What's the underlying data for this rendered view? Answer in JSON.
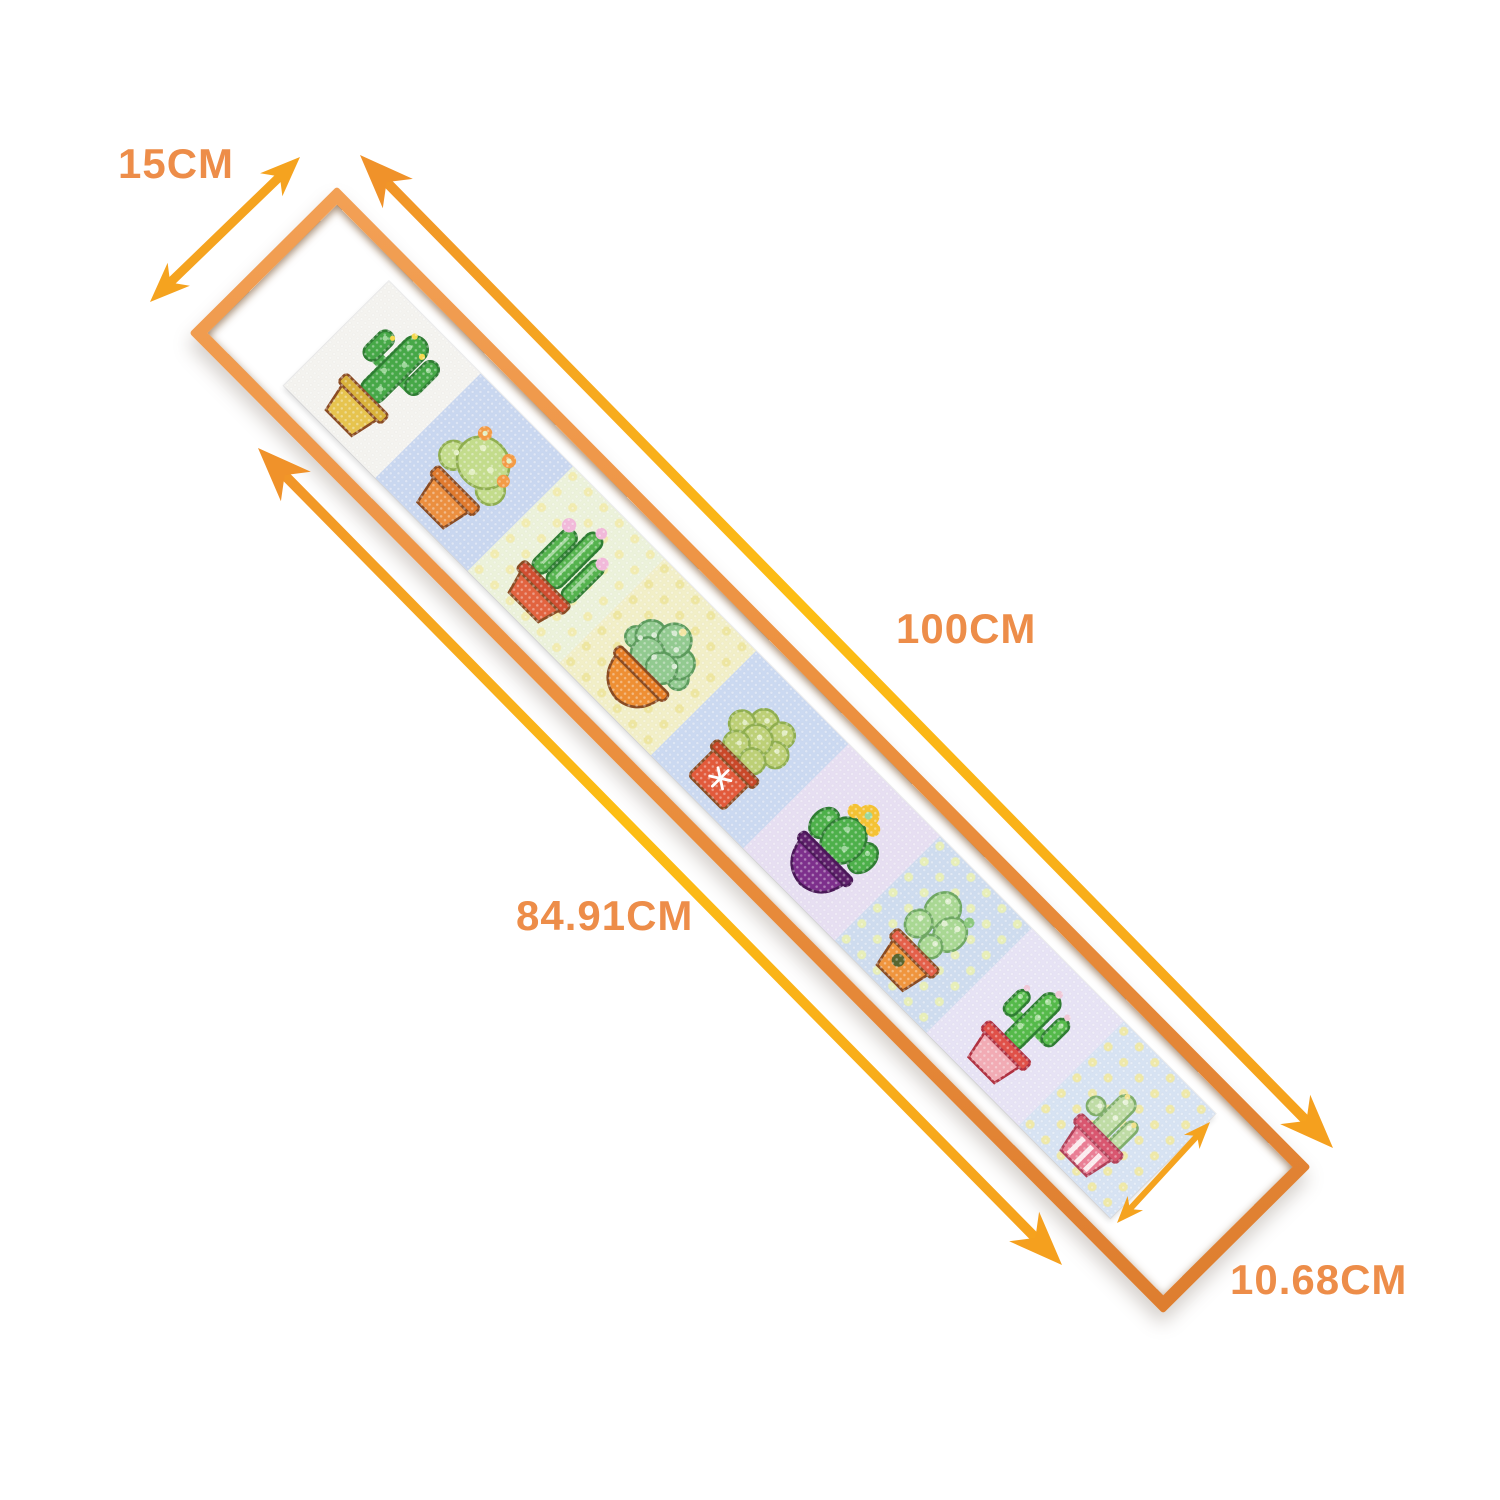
{
  "dimensions": {
    "frame_width": {
      "label": "15CM"
    },
    "frame_length": {
      "label": "100CM"
    },
    "art_length": {
      "label": "84.91CM"
    },
    "art_width": {
      "label": "10.68CM"
    }
  },
  "colors": {
    "label_text": "#ED8D49",
    "arrow": "#F5A31F",
    "arrow_gradient_start": "#F0922A",
    "arrow_gradient_mid": "#FDBE13",
    "arrow_gradient_end": "#F5A01E",
    "frame_wood": "#EC9140",
    "mat": "#FFFFFF"
  },
  "artwork": {
    "panels": [
      {
        "name": "saguaro-cactus-yellow-pot",
        "plant": "saguaro",
        "pot_shape": "flower",
        "bg": "#F4F3EF",
        "polka": "",
        "stripes": false,
        "body": "#46A847",
        "light": "#9ED89B",
        "accent": "#F6D94E",
        "outline": "#2E7D32",
        "pot": "#E7C44E",
        "pot_rim": "#D9B23B",
        "pot_outline": "#8A4B22",
        "pot_decor": ""
      },
      {
        "name": "round-cactus-orange-flowers",
        "plant": "roundpad",
        "pot_shape": "flower",
        "bg": "#C9D7F0",
        "polka": "",
        "stripes": false,
        "body": "#C3DC8B",
        "light": "#E4F0C4",
        "accent": "#F49B45",
        "outline": "#8FAE4F",
        "pot": "#EC8F3F",
        "pot_rim": "#E07A2E",
        "pot_outline": "#8A4B22",
        "pot_decor": ""
      },
      {
        "name": "column-cacti-pink-flowers",
        "plant": "columns",
        "pot_shape": "lowpot",
        "bg": "#ECF2DA",
        "polka": "#F2ECB0",
        "stripes": false,
        "body": "#55B34E",
        "light": "#A6D8A1",
        "accent": "#F2B9DA",
        "outline": "#2E7D32",
        "pot": "#E2633F",
        "pot_rim": "#D14E31",
        "pot_outline": "#8A4B22",
        "pot_decor": ""
      },
      {
        "name": "bushy-cactus-orange-bowl",
        "plant": "bush",
        "pot_shape": "bowl",
        "bg": "#F2EFC7",
        "polka": "#EEE6A0",
        "stripes": false,
        "body": "#92CA90",
        "light": "#D8EBD4",
        "accent": "#F4E6A3",
        "outline": "#5C9B5C",
        "pot": "#EF8F33",
        "pot_rim": "#E67C24",
        "pot_outline": "#8A4B22",
        "pot_decor": ""
      },
      {
        "name": "pad-cluster-red-box-pot",
        "plant": "pads",
        "pot_shape": "box",
        "bg": "#CBD9F1",
        "polka": "",
        "stripes": false,
        "body": "#BDD076",
        "light": "#E4EEC5",
        "accent": "#FFFFFF",
        "outline": "#8FAE4F",
        "pot": "#E25A3B",
        "pot_rim": "#C94829",
        "pot_outline": "#8A4B22",
        "pot_decor": "snowflake"
      },
      {
        "name": "crowned-cactus-purple-bowl",
        "plant": "crown",
        "pot_shape": "bowl",
        "bg": "#E7DFF2",
        "polka": "",
        "stripes": true,
        "body": "#4DB04A",
        "light": "#9DD79B",
        "accent": "#F5C233",
        "outline": "#2E7D32",
        "pot": "#7D2F8C",
        "pot_rim": "#5E1F6B",
        "pot_outline": "#4A1858",
        "pot_decor": ""
      },
      {
        "name": "lumpy-cactus-orange-pot",
        "plant": "lumpy",
        "pot_shape": "flower",
        "bg": "#CEDCEF",
        "polka": "#E8EFB8",
        "stripes": false,
        "body": "#A9D893",
        "light": "#E0F0D1",
        "accent": "#8CC97E",
        "outline": "#6FA862",
        "pot": "#F0953D",
        "pot_rim": "#E4604A",
        "pot_outline": "#8A4B22",
        "pot_decor": "hole"
      },
      {
        "name": "branching-cactus-pink-pot",
        "plant": "branchy",
        "pot_shape": "flower",
        "bg": "#E7E3F5",
        "polka": "",
        "stripes": false,
        "body": "#55BA4A",
        "light": "#A9E09F",
        "accent": "#F0C8D8",
        "outline": "#2E7D32",
        "pot": "#F2ABB4",
        "pot_rim": "#E05048",
        "pot_outline": "#B03040",
        "pot_decor": ""
      },
      {
        "name": "small-cactus-pink-striped-pot",
        "plant": "smallpair",
        "pot_shape": "flower",
        "bg": "#D7E3F3",
        "polka": "#EFE9A8",
        "stripes": false,
        "body": "#BFDCA5",
        "light": "#E8F3D9",
        "accent": "#F1E18A",
        "outline": "#7FAE6A",
        "pot": "#EA7E95",
        "pot_rim": "#D9566F",
        "pot_outline": "#B04058",
        "pot_decor": "stripes"
      }
    ]
  }
}
